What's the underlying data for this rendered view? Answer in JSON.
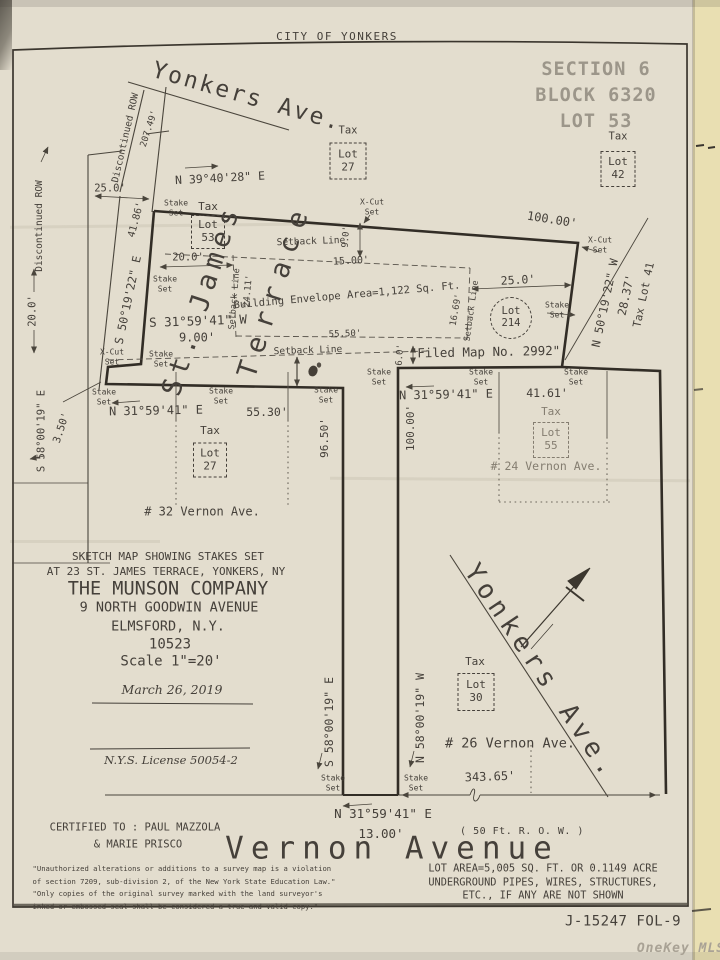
{
  "palette": {
    "paper": "#e3ddce",
    "paper_strip": "#e9dfb2",
    "ink": "#45403a",
    "ink_faded": "#847d70",
    "boundary": "#322d26",
    "stamp_gray": "#9c968a",
    "watermark": "#a9a295"
  },
  "labels": [
    {
      "id": "city-header",
      "t": "CITY OF YONKERS",
      "x": 337,
      "y": 37,
      "fs": 11,
      "sp": 1.5
    },
    {
      "id": "street-yonkers-ave-top",
      "t": "Yonkers Ave.",
      "x": 247,
      "y": 97,
      "fs": 23,
      "sp": 2.5,
      "rot": 16
    },
    {
      "id": "section-block-lot-stamp",
      "t": "SECTION 6\nBLOCK 6320\nLOT 53",
      "x": 596,
      "y": 96,
      "fs": 18.5,
      "sp": 1,
      "lh": 1.4,
      "cls": "gray"
    },
    {
      "id": "tax-label-27-top",
      "t": "Tax",
      "x": 348,
      "y": 131,
      "fs": 10.5
    },
    {
      "id": "tax-lot-27-top-box",
      "t": "Lot\n27",
      "x": 348,
      "y": 161,
      "fs": 11,
      "cls": "box",
      "w": 37,
      "h": 37
    },
    {
      "id": "tax-label-42",
      "t": "Tax",
      "x": 618,
      "y": 137,
      "fs": 10.5
    },
    {
      "id": "tax-lot-42-box",
      "t": "Lot\n42",
      "x": 618,
      "y": 169,
      "fs": 11,
      "cls": "box",
      "w": 35,
      "h": 36
    },
    {
      "id": "bearing-yonkers-frontage",
      "t": "N 39°40'28\" E",
      "x": 220,
      "y": 178,
      "fs": 11.5,
      "rot": -3
    },
    {
      "id": "dim-frontage-207-49",
      "t": "207.49'",
      "x": 150,
      "y": 129,
      "fs": 9,
      "rot": -72
    },
    {
      "id": "discontinued-row-upper",
      "t": "Discontinued ROW",
      "x": 126,
      "y": 138,
      "fs": 9.5,
      "rot": -77
    },
    {
      "id": "discontinued-row-left",
      "t": "Discontinued ROW",
      "x": 40,
      "y": 226,
      "fs": 9.5,
      "rot": -90
    },
    {
      "id": "dim-25-0-top-left",
      "t": "25.0'",
      "x": 110,
      "y": 189,
      "fs": 10.5
    },
    {
      "id": "dim-41-86",
      "t": "41.86'",
      "x": 137,
      "y": 220,
      "fs": 10,
      "rot": -75
    },
    {
      "id": "dim-20-0-row-width",
      "t": "20.0'",
      "x": 33,
      "y": 311,
      "fs": 10.5,
      "rot": -90
    },
    {
      "id": "street-st-james",
      "t": "St. James",
      "x": 202,
      "y": 300,
      "fs": 27,
      "sp": 6,
      "rot": -72
    },
    {
      "id": "street-terrace",
      "t": "Terrace",
      "x": 275,
      "y": 290,
      "fs": 27,
      "sp": 10,
      "rot": -72
    },
    {
      "id": "bearing-st-james-terrace",
      "t": "S 50°19'22\" E",
      "x": 128,
      "y": 300,
      "fs": 11.5,
      "rot": -78
    },
    {
      "id": "stake-set-nw",
      "t": "Stake\nSet",
      "x": 176,
      "y": 208,
      "fs": 8,
      "lh": 1.2
    },
    {
      "id": "tax-label-53",
      "t": "Tax",
      "x": 208,
      "y": 207,
      "fs": 11
    },
    {
      "id": "tax-lot-53-box",
      "t": "Lot\n53",
      "x": 208,
      "y": 232,
      "fs": 11,
      "cls": "box",
      "w": 34,
      "h": 34
    },
    {
      "id": "setback-line-top-label",
      "t": "Setback Line",
      "x": 311,
      "y": 242,
      "fs": 9.5,
      "rot": -2
    },
    {
      "id": "dim-9-0",
      "t": "9.0'",
      "x": 347,
      "y": 237,
      "fs": 9,
      "rot": -86
    },
    {
      "id": "xcut-set-top",
      "t": "X-Cut\nSet",
      "x": 372,
      "y": 207,
      "fs": 8,
      "lh": 1.2
    },
    {
      "id": "dim-15-00",
      "t": "15.00'",
      "x": 351,
      "y": 262,
      "fs": 10,
      "rot": -3
    },
    {
      "id": "dim-20-0-envelope",
      "t": "20.0'",
      "x": 188,
      "y": 258,
      "fs": 10.5
    },
    {
      "id": "stake-set-west",
      "t": "Stake\nSet",
      "x": 165,
      "y": 284,
      "fs": 8,
      "lh": 1.2
    },
    {
      "id": "setback-line-left-label",
      "t": "Setback Line",
      "x": 235,
      "y": 299,
      "fs": 8.5,
      "rot": -85
    },
    {
      "id": "dim-24-11",
      "t": "24.11'",
      "x": 249,
      "y": 291,
      "fs": 9,
      "rot": -85
    },
    {
      "id": "building-envelope-label",
      "t": "Building Envelope Area=1,122 Sq. Ft.",
      "x": 347,
      "y": 296,
      "fs": 10.5,
      "rot": -5
    },
    {
      "id": "dim-55-50",
      "t": "55.50'",
      "x": 345,
      "y": 335,
      "fs": 9,
      "rot": -2
    },
    {
      "id": "dim-16-69",
      "t": "16.69'",
      "x": 457,
      "y": 310,
      "fs": 9,
      "rot": -80
    },
    {
      "id": "setback-line-right-label",
      "t": "Setback Line",
      "x": 472,
      "y": 311,
      "fs": 8.5,
      "rot": -82
    },
    {
      "id": "bearing-s31-w",
      "t": "S 31°59'41\" W",
      "x": 198,
      "y": 321,
      "fs": 12.5,
      "rot": -2
    },
    {
      "id": "dim-9-00",
      "t": "9.00'",
      "x": 197,
      "y": 338,
      "fs": 12
    },
    {
      "id": "xcut-set-sw",
      "t": "X-Cut\nSet",
      "x": 112,
      "y": 357,
      "fs": 8,
      "lh": 1.2
    },
    {
      "id": "stake-set-sw",
      "t": "Stake\nSet",
      "x": 161,
      "y": 359,
      "fs": 8,
      "lh": 1.2
    },
    {
      "id": "setback-line-bottom-label",
      "t": "Setback Line",
      "x": 308,
      "y": 351,
      "fs": 9.5,
      "rot": -2
    },
    {
      "id": "dim-25-0-east",
      "t": "25.0'",
      "x": 518,
      "y": 280,
      "fs": 11.5,
      "rot": -3
    },
    {
      "id": "lot-214-circle",
      "t": "Lot\n214",
      "x": 511,
      "y": 318,
      "fs": 10.5,
      "cls": "circle",
      "w": 42,
      "h": 42
    },
    {
      "id": "stake-set-east",
      "t": "Stake\nSet",
      "x": 557,
      "y": 310,
      "fs": 8,
      "lh": 1.2
    },
    {
      "id": "dim-100-00-ne",
      "t": "100.00'",
      "x": 552,
      "y": 220,
      "fs": 12,
      "rot": 9
    },
    {
      "id": "xcut-set-ne",
      "t": "X-Cut\nSet",
      "x": 600,
      "y": 245,
      "fs": 8,
      "lh": 1.2
    },
    {
      "id": "bearing-n50-w",
      "t": "N 50°19'22\" W",
      "x": 605,
      "y": 303,
      "fs": 11.5,
      "rot": -78
    },
    {
      "id": "dim-28-37",
      "t": "28.37'",
      "x": 626,
      "y": 295,
      "fs": 11.5,
      "rot": -78
    },
    {
      "id": "tax-lot-41-label",
      "t": "Tax Lot 41",
      "x": 644,
      "y": 295,
      "fs": 11,
      "rot": -78
    },
    {
      "id": "filed-map-note",
      "t": "\"Filed Map No. 2992\"",
      "x": 485,
      "y": 352,
      "fs": 12.5,
      "rot": -1
    },
    {
      "id": "dim-6-0",
      "t": "6.0'",
      "x": 401,
      "y": 355,
      "fs": 9,
      "rot": -86
    },
    {
      "id": "stake-set-pole-top",
      "t": "Stake\nSet",
      "x": 379,
      "y": 377,
      "fs": 8,
      "lh": 1.2
    },
    {
      "id": "stake-set-32-nw",
      "t": "Stake\nSet",
      "x": 104,
      "y": 397,
      "fs": 8,
      "lh": 1.2
    },
    {
      "id": "bearing-n31-e-32",
      "t": "N 31°59'41\" E",
      "x": 156,
      "y": 411,
      "fs": 12,
      "rot": -1
    },
    {
      "id": "dim-55-30",
      "t": "55.30'",
      "x": 267,
      "y": 412,
      "fs": 11.5
    },
    {
      "id": "stake-set-32-mid",
      "t": "Stake\nSet",
      "x": 221,
      "y": 396,
      "fs": 8,
      "lh": 1.2
    },
    {
      "id": "stake-set-32-ne",
      "t": "Stake\nSet",
      "x": 326,
      "y": 395,
      "fs": 8,
      "lh": 1.2
    },
    {
      "id": "tax-label-27-lower",
      "t": "Tax",
      "x": 210,
      "y": 431,
      "fs": 11
    },
    {
      "id": "tax-lot-27-lower-box",
      "t": "Lot\n27",
      "x": 210,
      "y": 460,
      "fs": 11,
      "cls": "box",
      "w": 34,
      "h": 35
    },
    {
      "id": "address-32-vernon",
      "t": "# 32 Vernon Ave.",
      "x": 202,
      "y": 512,
      "fs": 12
    },
    {
      "id": "dim-96-50",
      "t": "96.50'",
      "x": 325,
      "y": 438,
      "fs": 11,
      "rot": -90
    },
    {
      "id": "bearing-s58-e-left",
      "t": "S 58°00'19\" E",
      "x": 42,
      "y": 431,
      "fs": 10.5,
      "rot": -90
    },
    {
      "id": "dim-3-50",
      "t": "3.50'",
      "x": 62,
      "y": 428,
      "fs": 10.5,
      "rot": -72
    },
    {
      "id": "stake-set-24-nw",
      "t": "Stake\nSet",
      "x": 481,
      "y": 377,
      "fs": 8,
      "lh": 1.2
    },
    {
      "id": "stake-set-24-ne",
      "t": "Stake\nSet",
      "x": 576,
      "y": 377,
      "fs": 8,
      "lh": 1.2
    },
    {
      "id": "bearing-n31-e-24",
      "t": "N 31°59'41\" E",
      "x": 446,
      "y": 395,
      "fs": 12,
      "rot": -1
    },
    {
      "id": "dim-41-61",
      "t": "41.61'",
      "x": 547,
      "y": 393,
      "fs": 11.5
    },
    {
      "id": "tax-label-55",
      "t": "Tax",
      "x": 551,
      "y": 412,
      "fs": 11,
      "cls": "faded"
    },
    {
      "id": "tax-lot-55-box",
      "t": "Lot\n55",
      "x": 551,
      "y": 440,
      "fs": 11,
      "cls": "box faded",
      "w": 36,
      "h": 36
    },
    {
      "id": "address-24-vernon",
      "t": "# 24 Vernon Ave.",
      "x": 546,
      "y": 466,
      "fs": 11.5,
      "cls": "faded"
    },
    {
      "id": "dim-100-00-pole",
      "t": "100.00'",
      "x": 411,
      "y": 428,
      "fs": 11,
      "rot": -90
    },
    {
      "id": "title-line-1",
      "t": "SKETCH MAP SHOWING STAKES SET",
      "x": 168,
      "y": 557,
      "fs": 11
    },
    {
      "id": "title-line-2",
      "t": "AT 23 ST. JAMES TERRACE, YONKERS, NY",
      "x": 166,
      "y": 572,
      "fs": 11
    },
    {
      "id": "company-name",
      "t": "THE MUNSON COMPANY",
      "x": 168,
      "y": 589,
      "fs": 18.5
    },
    {
      "id": "company-address",
      "t": "9 NORTH GOODWIN AVENUE",
      "x": 169,
      "y": 608,
      "fs": 13.5
    },
    {
      "id": "company-city",
      "t": "ELMSFORD, N.Y.",
      "x": 168,
      "y": 627,
      "fs": 13.5
    },
    {
      "id": "company-zip",
      "t": "10523",
      "x": 170,
      "y": 645,
      "fs": 14
    },
    {
      "id": "scale-note",
      "t": "Scale 1\"=20'",
      "x": 171,
      "y": 662,
      "fs": 14
    },
    {
      "id": "survey-date",
      "t": "March 26, 2019",
      "x": 172,
      "y": 690,
      "fs": 12.5,
      "cls": "italic"
    },
    {
      "id": "nys-license",
      "t": "N.Y.S. License 50054-2",
      "x": 171,
      "y": 760,
      "fs": 11.5,
      "cls": "italic"
    },
    {
      "id": "bearing-s58-e-pole",
      "t": "S 58°00'19\" E",
      "x": 329,
      "y": 722,
      "fs": 11.5,
      "rot": -90
    },
    {
      "id": "bearing-n58-w-pole",
      "t": "N 58°00'19\" W",
      "x": 420,
      "y": 718,
      "fs": 11.5,
      "rot": -90
    },
    {
      "id": "stake-set-pole-sw",
      "t": "Stake\nSet",
      "x": 333,
      "y": 783,
      "fs": 8,
      "lh": 1.2
    },
    {
      "id": "stake-set-pole-se",
      "t": "Stake\nSet",
      "x": 416,
      "y": 783,
      "fs": 8,
      "lh": 1.2
    },
    {
      "id": "bearing-n31-e-pole",
      "t": "N 31°59'41\" E",
      "x": 383,
      "y": 814,
      "fs": 12.5
    },
    {
      "id": "dim-13-00",
      "t": "13.00'",
      "x": 381,
      "y": 834,
      "fs": 12.5
    },
    {
      "id": "street-yonkers-ave-diag",
      "t": "Yonkers Ave.",
      "x": 541,
      "y": 672,
      "fs": 26,
      "sp": 5.5,
      "rot": 56
    },
    {
      "id": "tax-label-30",
      "t": "Tax",
      "x": 475,
      "y": 662,
      "fs": 11
    },
    {
      "id": "tax-lot-30-box",
      "t": "Lot\n30",
      "x": 476,
      "y": 692,
      "fs": 11,
      "cls": "box",
      "w": 37,
      "h": 38
    },
    {
      "id": "address-26-vernon",
      "t": "# 26 Vernon Ave.",
      "x": 510,
      "y": 744,
      "fs": 13.5
    },
    {
      "id": "dim-343-65",
      "t": "343.65'",
      "x": 490,
      "y": 777,
      "fs": 12,
      "rot": -2
    },
    {
      "id": "certified-to-line-1",
      "t": "CERTIFIED TO : PAUL MAZZOLA",
      "x": 135,
      "y": 828,
      "fs": 10.5
    },
    {
      "id": "certified-to-line-2",
      "t": "& MARIE PRISCO",
      "x": 138,
      "y": 845,
      "fs": 10.5
    },
    {
      "id": "disclaimer-note",
      "t": "\"Unauthorized alterations or additions to a survey map is a violation\nof section 7209, sub-division 2, of the New York State Education Law.\"\n\"Only copies of the original survey marked with the land surveyor's\ninked or embossed seal shall be considered a true and valid copy.\"",
      "x": 184,
      "y": 888,
      "fs": 7.2,
      "lh": 1.75,
      "cls": "left"
    },
    {
      "id": "row-width-note",
      "t": "( 50 Ft. R. O. W. )",
      "x": 522,
      "y": 832,
      "fs": 10,
      "sp": 0.5
    },
    {
      "id": "street-vernon-avenue",
      "t": "Vernon Avenue",
      "x": 392,
      "y": 849,
      "fs": 31,
      "sp": 7
    },
    {
      "id": "lot-area-note",
      "t": "LOT A­REA=5,005 SQ. FT. OR 0.1149 ACRE\nUNDERGROUND PIPES, WIRES, STRUCTURES,\nETC., IF ANY ARE NOT SHOWN",
      "x": 543,
      "y": 883,
      "fs": 10.3,
      "lh": 1.32
    },
    {
      "id": "job-number",
      "t": "J-15247 FOL-9",
      "x": 623,
      "y": 922,
      "fs": 14,
      "sp": 0.5
    },
    {
      "id": "watermark-onekey-mls",
      "t": "OneKey MLS",
      "x": 681,
      "y": 949,
      "fs": 13,
      "cls": "wm"
    }
  ]
}
